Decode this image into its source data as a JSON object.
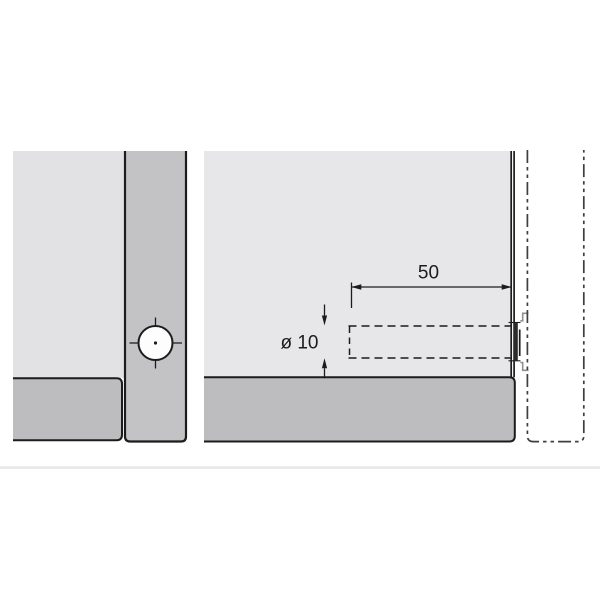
{
  "drawing": {
    "kind": "furniture-connector-drilling-diagram",
    "dimensions": {
      "depth": {
        "label": "50"
      },
      "diameter": {
        "label": "ø 10"
      }
    },
    "colors": {
      "panel_face_left": "#e2e2e4",
      "panel_face_right": "#e7e7e9",
      "panel_edge_strip": "#c3c3c5",
      "bottom_panel": "#bdbdbf",
      "hole_fill": "#fdfdfd",
      "line": "#1c1c1c",
      "phantom_line": "#3f3f3f",
      "hardware_outline": "#8f8f8f",
      "divider": "#e8e8e8"
    }
  }
}
